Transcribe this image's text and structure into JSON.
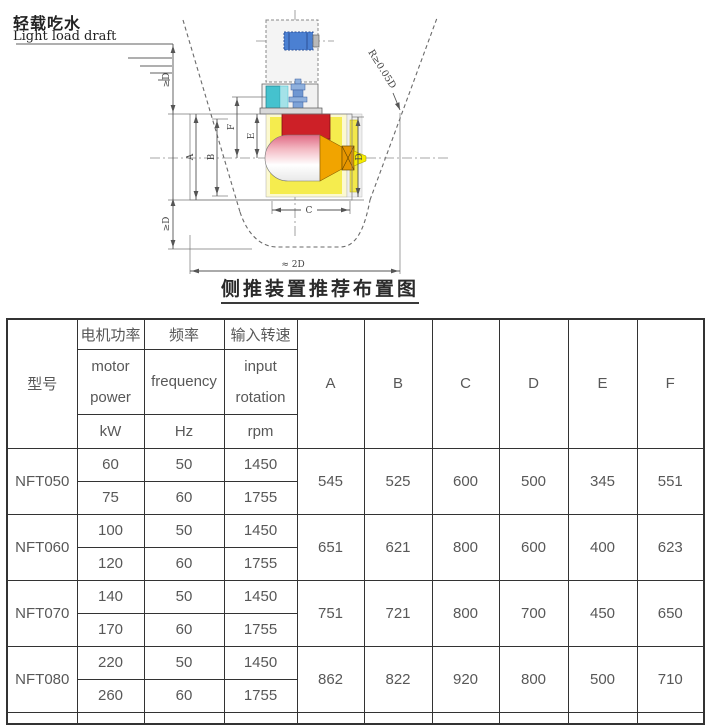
{
  "diagram": {
    "labels": {
      "draft_cn": "轻载吃水",
      "draft_en": "Light load draft",
      "ge_d": "≥D",
      "radius": "R≥0.05D",
      "approx_2d": "≈ 2D",
      "a": "A",
      "b": "B",
      "c": "C",
      "d": "D",
      "e": "E",
      "f": "F",
      "caption": "侧推装置推荐布置图"
    }
  },
  "table": {
    "col_headers": {
      "model": "型号",
      "groups": [
        {
          "cn": "电机功率",
          "en1": "motor",
          "en2": "power",
          "unit": "kW"
        },
        {
          "cn": "频率",
          "en1": "frequency",
          "en2": "",
          "unit": "Hz"
        },
        {
          "cn": "输入转速",
          "en1": "input",
          "en2": "rotation",
          "unit": "rpm"
        }
      ],
      "dims": [
        "A",
        "B",
        "C",
        "D",
        "E",
        "F"
      ]
    },
    "rows": [
      {
        "model": "NFT050",
        "variants": [
          [
            "60",
            "50",
            "1450"
          ],
          [
            "75",
            "60",
            "1755"
          ]
        ],
        "dims": [
          "545",
          "525",
          "600",
          "500",
          "345",
          "551"
        ]
      },
      {
        "model": "NFT060",
        "variants": [
          [
            "100",
            "50",
            "1450"
          ],
          [
            "120",
            "60",
            "1755"
          ]
        ],
        "dims": [
          "651",
          "621",
          "800",
          "600",
          "400",
          "623"
        ]
      },
      {
        "model": "NFT070",
        "variants": [
          [
            "140",
            "50",
            "1450"
          ],
          [
            "170",
            "60",
            "1755"
          ]
        ],
        "dims": [
          "751",
          "721",
          "800",
          "700",
          "450",
          "650"
        ]
      },
      {
        "model": "NFT080",
        "variants": [
          [
            "220",
            "50",
            "1450"
          ],
          [
            "260",
            "60",
            "1755"
          ]
        ],
        "dims": [
          "862",
          "822",
          "920",
          "800",
          "500",
          "710"
        ]
      }
    ]
  },
  "colors": {
    "border": "#333333",
    "header_bg": "#f5f5f5",
    "text": "#585858",
    "motor_blue": "#4b80d2",
    "gear_cyan": "#45c2ce",
    "shaft_red": "#cd2027",
    "tunnel_yellow": "#f5ec4e",
    "cone_orange": "#f1a400"
  }
}
